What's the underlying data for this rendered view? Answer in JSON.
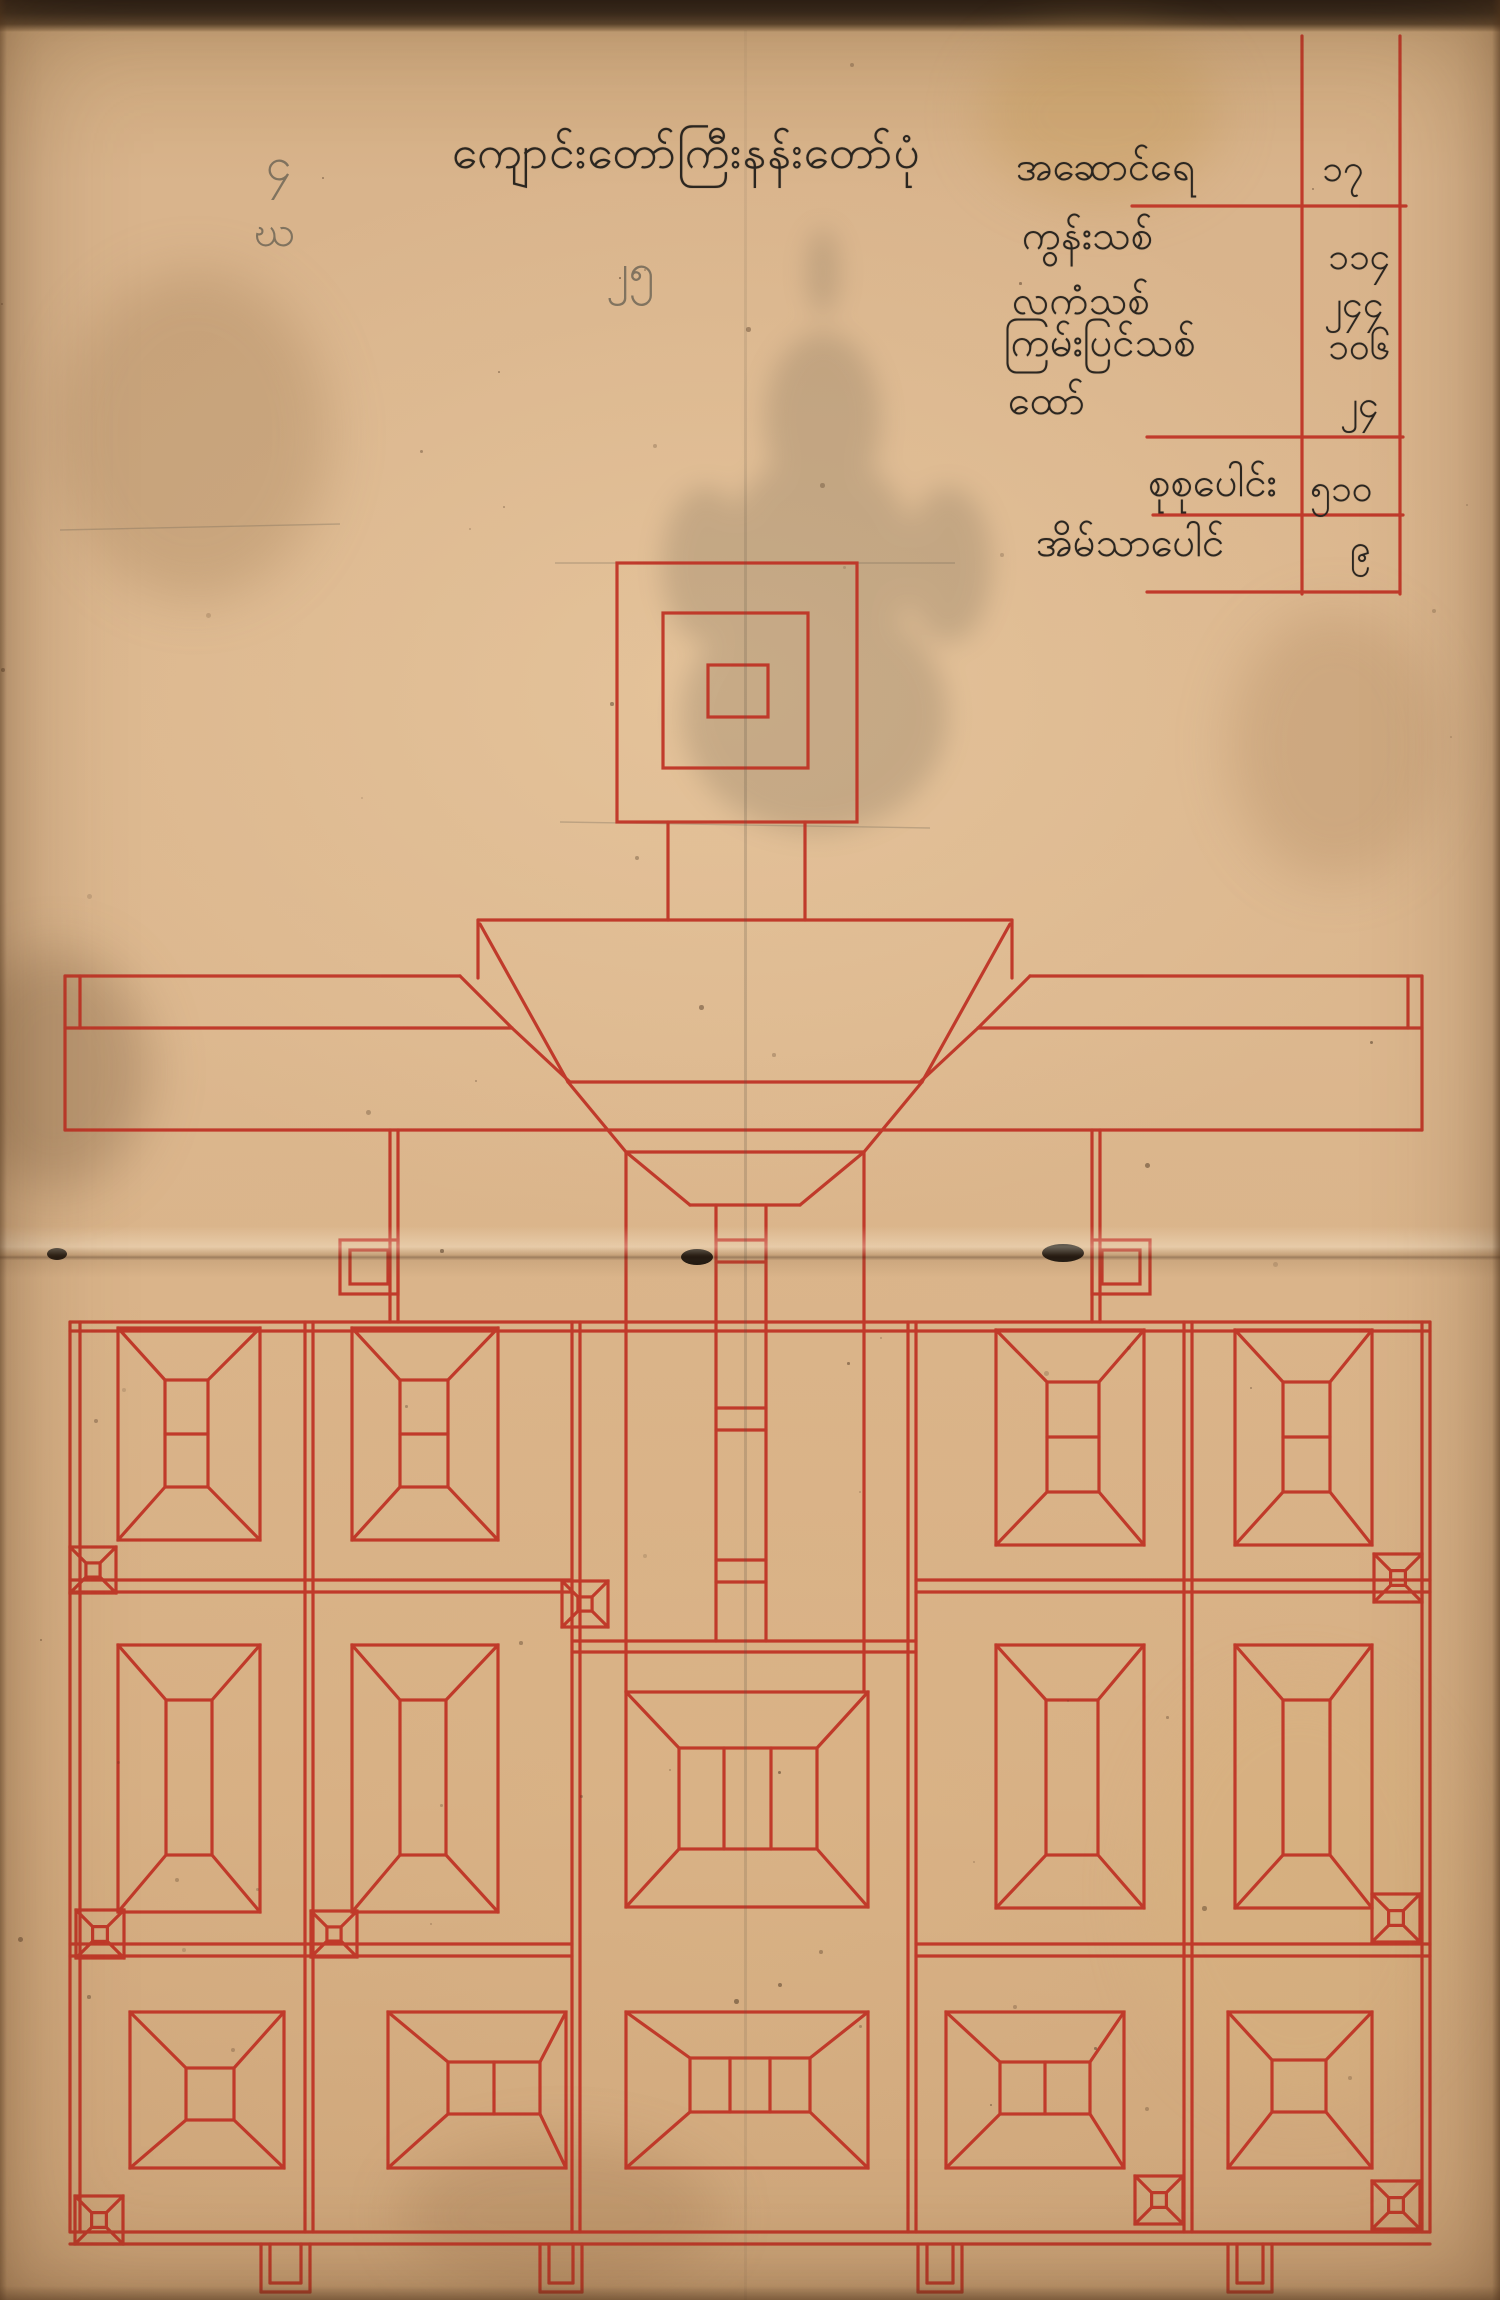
{
  "document": {
    "kind": "hand-drawn monastery plan manuscript, red ink on aged paper",
    "title": "ကျောင်းတော်ကြီးနန်းတော်ပုံ"
  },
  "colors": {
    "paper": "#d9b48c",
    "ink_red": "#bf3325",
    "ink_black": "#2b2620",
    "pencil_gray": "#6b6354"
  },
  "pencil_marks": {
    "top_left_upper": "၄",
    "top_left_lower": "ဃ",
    "near_title": "၂၅"
  },
  "table": {
    "rows": [
      {
        "label": "အဆောင်ရေ",
        "value": "၁၇"
      },
      {
        "label": "ကွန်းသစ်",
        "value": "၁၁၄"
      },
      {
        "label": "လကံသစ်",
        "value": "၂၄၄"
      },
      {
        "label": "ကြမ်းပြင်သစ်",
        "value": "၁၀၆"
      },
      {
        "label": "ထော်",
        "value": "၂၄"
      }
    ],
    "total_row": {
      "label": "စုစုပေါင်း",
      "value": "၅၁၀"
    },
    "footer_row": {
      "label": "အိမ်သာပေါင်",
      "value": "၉"
    }
  }
}
